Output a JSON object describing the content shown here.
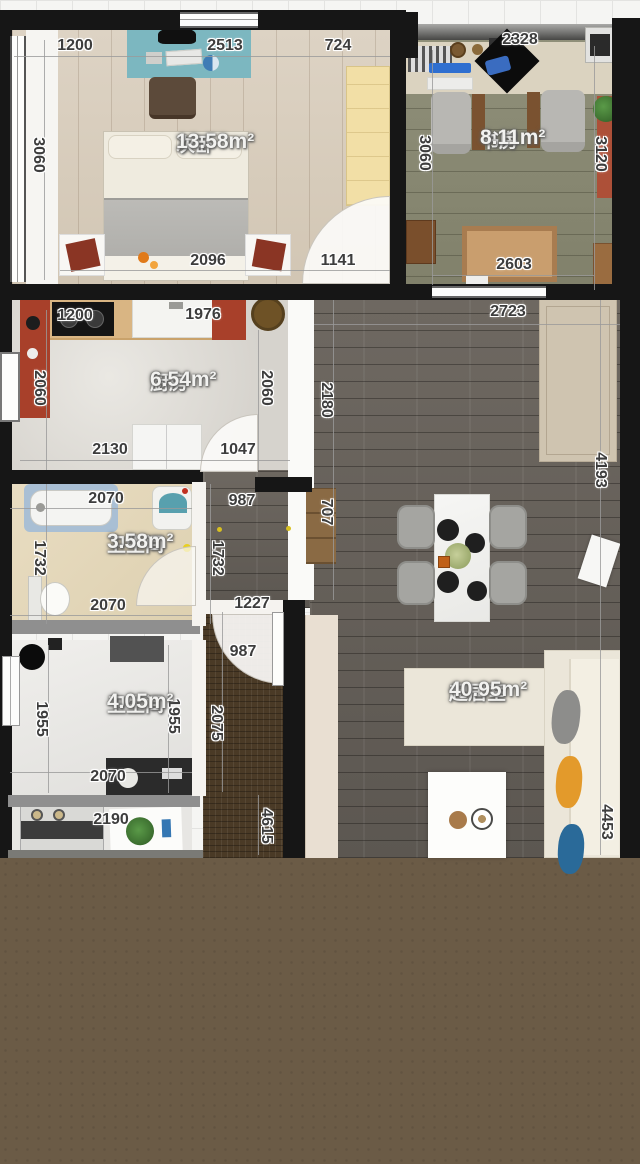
{
  "palette": {
    "background_grid": "#f5f5f3",
    "bottom_fill": "#6b5b46",
    "wall": "#161616",
    "bedroom_floor": "#d7ccba",
    "study_floor": "#88886f",
    "kitchen_floor": "#dfdcd6",
    "bath1_floor": "#e5d9bd",
    "bath2_floor": "#ebeae7",
    "living_floor": "#645e58",
    "corridor_floor": "#4a3a26",
    "desk_rug_teal": "#7cb7c0",
    "cabinet_red": "#a8402a",
    "sofa_cream": "#ebe6d9",
    "pillow_orange": "#e39a2b",
    "pillow_blue": "#2a6a99"
  },
  "rooms": [
    {
      "id": "bedroom",
      "name": "次卧",
      "area": "13.58m²",
      "label_x": 176,
      "label_y": 130
    },
    {
      "id": "study",
      "name": "书房",
      "area": "8.11m²",
      "label_x": 480,
      "label_y": 126
    },
    {
      "id": "kitchen",
      "name": "厨房",
      "area": "6.54m²",
      "label_x": 150,
      "label_y": 368
    },
    {
      "id": "bath-1",
      "name": "卫生间",
      "area": "3.58m²",
      "label_x": 107,
      "label_y": 530
    },
    {
      "id": "bath-2",
      "name": "卫生间",
      "area": "4.05m²",
      "label_x": 107,
      "label_y": 690
    },
    {
      "id": "living",
      "name": "起居室",
      "area": "40.95m²",
      "label_x": 449,
      "label_y": 678
    }
  ],
  "dim_labels": [
    {
      "t": "1200",
      "x": 75,
      "y": 46,
      "v": false
    },
    {
      "t": "2513",
      "x": 225,
      "y": 46,
      "v": false
    },
    {
      "t": "724",
      "x": 338,
      "y": 46,
      "v": false
    },
    {
      "t": "2328",
      "x": 520,
      "y": 40,
      "v": false
    },
    {
      "t": "2096",
      "x": 208,
      "y": 261,
      "v": false
    },
    {
      "t": "1141",
      "x": 338,
      "y": 261,
      "v": false
    },
    {
      "t": "2603",
      "x": 514,
      "y": 265,
      "v": false
    },
    {
      "t": "1200",
      "x": 75,
      "y": 316,
      "v": false
    },
    {
      "t": "1976",
      "x": 203,
      "y": 315,
      "v": false
    },
    {
      "t": "2723",
      "x": 508,
      "y": 312,
      "v": false
    },
    {
      "t": "2130",
      "x": 110,
      "y": 450,
      "v": false
    },
    {
      "t": "1047",
      "x": 238,
      "y": 450,
      "v": false
    },
    {
      "t": "2070",
      "x": 106,
      "y": 499,
      "v": false
    },
    {
      "t": "987",
      "x": 242,
      "y": 501,
      "v": false
    },
    {
      "t": "2070",
      "x": 108,
      "y": 606,
      "v": false
    },
    {
      "t": "1227",
      "x": 252,
      "y": 604,
      "v": false
    },
    {
      "t": "987",
      "x": 243,
      "y": 652,
      "v": false
    },
    {
      "t": "2070",
      "x": 108,
      "y": 777,
      "v": false
    },
    {
      "t": "2190",
      "x": 111,
      "y": 820,
      "v": false
    },
    {
      "t": "3060",
      "x": 38,
      "y": 155,
      "v": true
    },
    {
      "t": "3060",
      "x": 424,
      "y": 153,
      "v": true
    },
    {
      "t": "3120",
      "x": 600,
      "y": 154,
      "v": true
    },
    {
      "t": "2060",
      "x": 39,
      "y": 388,
      "v": true
    },
    {
      "t": "2060",
      "x": 266,
      "y": 388,
      "v": true
    },
    {
      "t": "2180",
      "x": 326,
      "y": 400,
      "v": true
    },
    {
      "t": "707",
      "x": 326,
      "y": 512,
      "v": true
    },
    {
      "t": "4193",
      "x": 600,
      "y": 470,
      "v": true
    },
    {
      "t": "1732",
      "x": 39,
      "y": 558,
      "v": true
    },
    {
      "t": "1732",
      "x": 217,
      "y": 558,
      "v": true
    },
    {
      "t": "1955",
      "x": 41,
      "y": 719,
      "v": true
    },
    {
      "t": "1955",
      "x": 173,
      "y": 716,
      "v": true
    },
    {
      "t": "2075",
      "x": 216,
      "y": 723,
      "v": true
    },
    {
      "t": "4615",
      "x": 266,
      "y": 826,
      "v": true
    },
    {
      "t": "4453",
      "x": 606,
      "y": 822,
      "v": true
    }
  ]
}
